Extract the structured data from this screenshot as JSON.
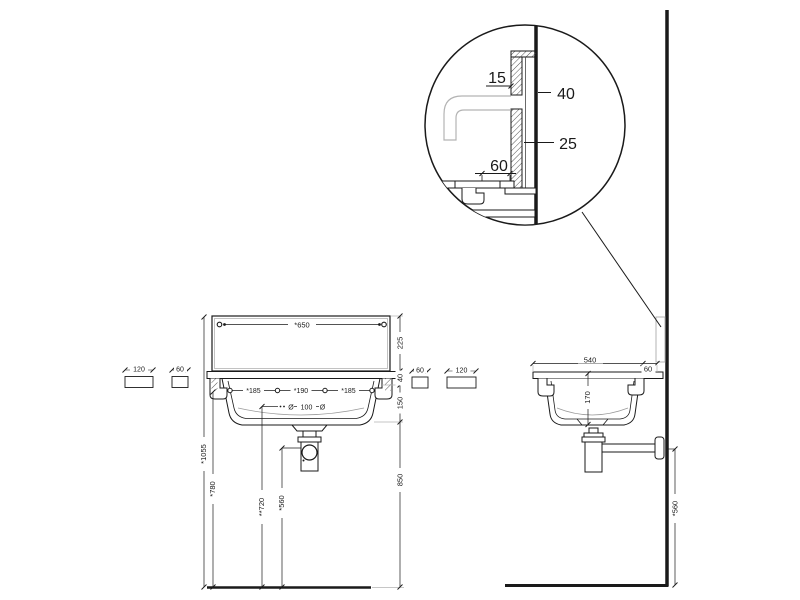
{
  "drawing": {
    "colors": {
      "line": "#1a1a1a",
      "light": "#b3b3b3",
      "background": "#ffffff"
    },
    "detail_view": {
      "dim_15": "15",
      "dim_40": "40",
      "dim_25": "25",
      "dim_60": "60"
    },
    "front_view": {
      "width": "*650",
      "backsplash_height": "225",
      "rim_height": "40",
      "basin_depth": "150",
      "floor_clearance": "850",
      "hole_spacing_left": "*185",
      "hole_spacing_center": "*190",
      "hole_spacing_right": "*185",
      "drain_symbol_left": "Ø",
      "drain_value": "100",
      "drain_symbol_right": "Ø",
      "total_height": "*1055",
      "rim_floor_height": "*780",
      "drain_floor_height": "**720",
      "trap_floor_height": "*560",
      "bracket_left_120": "120",
      "bracket_left_60": "60",
      "bracket_right_60": "60",
      "bracket_right_120": "120"
    },
    "side_view": {
      "depth": "540",
      "wall_gap": "60",
      "basin_inner_depth": "170",
      "outlet_floor_height": "*560"
    }
  }
}
